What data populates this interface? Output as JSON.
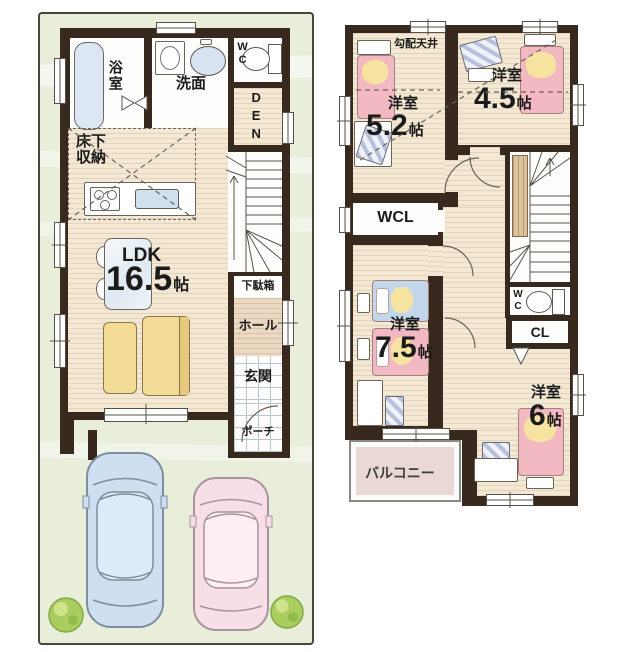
{
  "colors": {
    "wall": "#38291f",
    "wood_floor": "#f3e8d4",
    "site_green": "#e9eedb",
    "bed_pink": "#f2b9c3",
    "pillow_yellow": "#f6e3a0",
    "blanket_blue": "#c2d8ea",
    "sofa_yellow": "#f3dd96",
    "bathtub_blue": "#dde7f3",
    "balcony_pink": "#e9d8d4",
    "car_blue": "#cddff0",
    "car_pink": "#f8dfe7"
  },
  "floor1": {
    "bathroom": {
      "label": "浴室"
    },
    "washroom": {
      "label": "洗面"
    },
    "wc": {
      "label": "WC"
    },
    "den": {
      "label": "DEN"
    },
    "underfloor_storage": {
      "line1": "床下",
      "line2": "収納"
    },
    "ldk": {
      "label": "LDK",
      "size": "16.5",
      "unit": "帖"
    },
    "shoe_box": {
      "label": "下駄箱"
    },
    "hall": {
      "label": "ホール"
    },
    "entrance": {
      "label": "玄関"
    },
    "porch": {
      "label": "ポーチ"
    }
  },
  "floor2": {
    "sloped_ceiling": {
      "label": "勾配天井"
    },
    "room_5_2": {
      "label": "洋室",
      "size": "5.2",
      "unit": "帖"
    },
    "room_4_5": {
      "label": "洋室",
      "size": "4.5",
      "unit": "帖"
    },
    "wcl": {
      "label": "WCL"
    },
    "wc": {
      "label": "WC"
    },
    "cl": {
      "label": "CL"
    },
    "room_7_5": {
      "label": "洋室",
      "size": "7.5",
      "unit": "帖"
    },
    "room_6": {
      "label": "洋室",
      "size": "6",
      "unit": "帖"
    },
    "balcony": {
      "label": "バルコニー"
    }
  }
}
